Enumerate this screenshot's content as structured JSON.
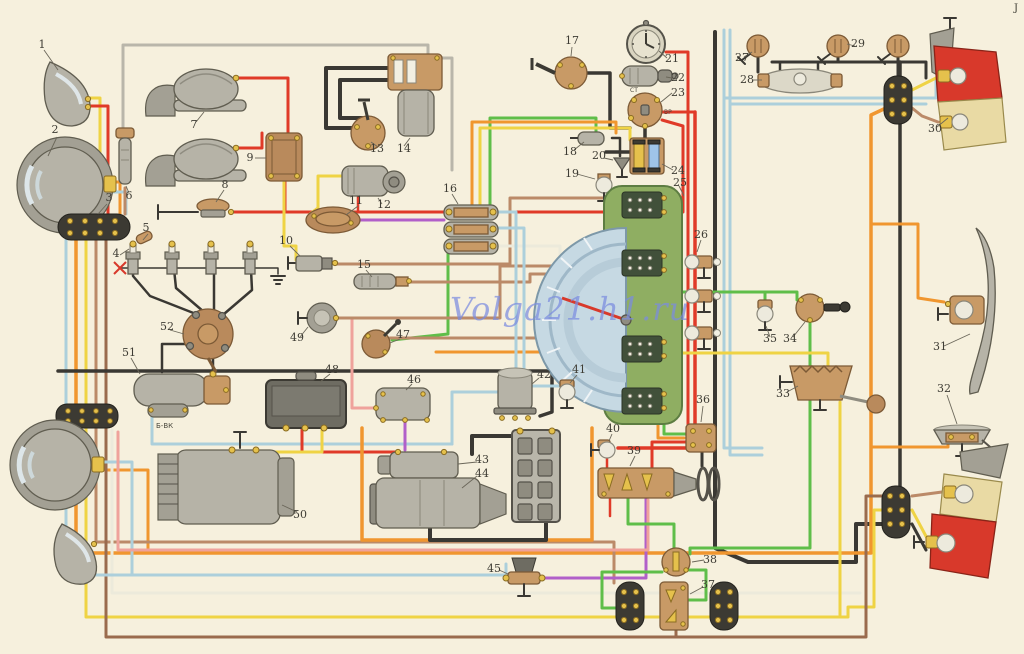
{
  "meta": {
    "watermark": "Volga21.h1.ru",
    "corner_mark": "J",
    "coil_resistor_label": "Б-ВК",
    "ignition_terminal_st": "СТ",
    "ignition_terminal_vr": "ВР"
  },
  "palette": {
    "background": "#f6f0dd",
    "wire_black": "#3a3833",
    "wire_red": "#e03a28",
    "wire_orange": "#f0962f",
    "wire_yellow": "#efd344",
    "wire_lightblue": "#accfdb",
    "wire_green": "#5fbe49",
    "wire_violet": "#b15fc9",
    "wire_pink": "#efa29b",
    "wire_brown": "#bb8a68",
    "wire_darkbrown": "#9a6b4d",
    "wire_white": "#eceadb",
    "wire_gray": "#b9b6aa",
    "panel_green": "#8fae62",
    "lamp_red": "#d8392b",
    "lamp_cream": "#e9daa4"
  },
  "callouts": {
    "c1": "1",
    "c2": "2",
    "c3": "3",
    "c4": "4",
    "c5": "5",
    "c6": "6",
    "c7": "7",
    "c8": "8",
    "c9": "9",
    "c10": "10",
    "c11": "11",
    "c12": "12",
    "c13": "13",
    "c14": "14",
    "c15": "15",
    "c16": "16",
    "c17": "17",
    "c18": "18",
    "c19": "19",
    "c20": "20",
    "c21": "21",
    "c22": "22",
    "c23": "23",
    "c24": "24",
    "c25": "25",
    "c26": "26",
    "c27": "27",
    "c28": "28",
    "c29": "29",
    "c30": "30",
    "c31": "31",
    "c32": "32",
    "c33": "33",
    "c34": "34",
    "c35": "35",
    "c36": "36",
    "c37": "37",
    "c38": "38",
    "c39": "39",
    "c40": "40",
    "c41": "41",
    "c42": "42",
    "c43": "43",
    "c44": "44",
    "c45": "45",
    "c46": "46",
    "c47": "47",
    "c48": "48",
    "c49": "49",
    "c50": "50",
    "c51": "51",
    "c52": "52"
  },
  "wires": [
    {
      "name": "wire-gray-fuse6-wiper",
      "c": "#b9b6aa",
      "w": 3,
      "p": "123,130 123,45 428,45 428,58"
    },
    {
      "name": "wire-gray-wiper-branch",
      "c": "#b9b6aa",
      "w": 3,
      "p": "436,58 452,58 452,170"
    },
    {
      "name": "wire-black-wiper-loop-outer",
      "c": "#3a3833",
      "w": 4,
      "p": "352,128 326,128 326,68 392,68"
    },
    {
      "name": "wire-black-wiper-loop-inner",
      "c": "#3a3833",
      "w": 4,
      "p": "362,118 340,118 340,80 392,80"
    },
    {
      "name": "wire-red-horn1",
      "c": "#e03a28",
      "w": 3,
      "p": "236,78 288,78 288,133"
    },
    {
      "name": "wire-red-horn2",
      "c": "#e03a28",
      "w": 3,
      "p": "236,148 262,148 262,133"
    },
    {
      "name": "wire-red-hornrelay-out",
      "c": "#e03a28",
      "w": 3,
      "p": "285,181 285,212"
    },
    {
      "name": "wire-red-hornbutton-ignition",
      "c": "#e03a28",
      "w": 3,
      "p": "234,212 683,212 683,126 662,120"
    },
    {
      "name": "wire-red-clock-feed",
      "c": "#e03a28",
      "w": 3,
      "p": "666,52 688,52 688,442 652,442 652,470"
    },
    {
      "name": "wire-red-ignition-junction",
      "c": "#e03a28",
      "w": 3,
      "p": "662,112 695,112"
    },
    {
      "name": "wire-red-main-trunk",
      "c": "#e03a28",
      "w": 3.5,
      "p": "695,112 695,448 618,448"
    },
    {
      "name": "wire-red-lamp40-drop",
      "c": "#e03a28",
      "w": 2.5,
      "p": "607,458 607,468"
    },
    {
      "name": "wire-red-39-drop",
      "c": "#e03a28",
      "w": 2.5,
      "p": "610,498 610,516"
    },
    {
      "name": "wire-black-17-feed",
      "c": "#3a3833",
      "w": 3.5,
      "p": "587,73 610,73 610,128 630,128"
    },
    {
      "name": "wire-black-23-24",
      "c": "#3a3833",
      "w": 3.5,
      "p": "645,127 645,152 606,152"
    },
    {
      "name": "wire-black-18-20",
      "c": "#3a3833",
      "w": 2.5,
      "p": "612,138 620,138 620,156"
    },
    {
      "name": "wire-black-door27-drop",
      "c": "#3a3833",
      "w": 3,
      "p": "758,57 758,72"
    },
    {
      "name": "wire-black-dome-run",
      "c": "#3a3833",
      "w": 3,
      "p": "772,62 926,62 926,78"
    },
    {
      "name": "wire-black-door29a-drop",
      "c": "#3a3833",
      "w": 3,
      "p": "838,57 838,62"
    },
    {
      "name": "wire-black-door29b-drop",
      "c": "#3a3833",
      "w": 3,
      "p": "898,57 898,78"
    },
    {
      "name": "wire-lblue-top-run1",
      "c": "#accfdb",
      "w": 3,
      "p": "724,98 936,98 936,80"
    },
    {
      "name": "wire-lblue-top-run2",
      "c": "#accfdb",
      "w": 3,
      "p": "730,104 926,104"
    },
    {
      "name": "wire-lblue-trunk1",
      "c": "#accfdb",
      "w": 3,
      "p": "724,30 724,448 762,448"
    },
    {
      "name": "wire-lblue-trunk2",
      "c": "#accfdb",
      "w": 3,
      "p": "730,30 730,455 762,455"
    },
    {
      "name": "wire-black-main-trunk",
      "c": "#3a3833",
      "w": 4,
      "p": "715,32 715,548 748,562 856,562 856,524 882,524"
    },
    {
      "name": "wire-black-right-trunk",
      "c": "#3a3833",
      "w": 3.5,
      "p": "900,62 900,486"
    },
    {
      "name": "wire-yellow-conn-tail30",
      "c": "#efd344",
      "w": 3,
      "p": "912,90 936,78"
    },
    {
      "name": "wire-tan-conn-tail30",
      "c": "#bb8a68",
      "w": 3,
      "p": "912,108 922,116 938,122"
    },
    {
      "name": "wire-orange-main-loop",
      "c": "#f0962f",
      "w": 3.5,
      "p": "76,240 76,553 871,553 871,115 886,108"
    },
    {
      "name": "wire-orange-headlamp-stub",
      "c": "#f0962f",
      "w": 3,
      "p": "100,470 148,470 148,553"
    },
    {
      "name": "wire-orange-trunklamp31",
      "c": "#f0962f",
      "w": 3,
      "p": "871,224 918,224 918,298 944,302"
    },
    {
      "name": "wire-orange-fuelsender32",
      "c": "#f0962f",
      "w": 3,
      "p": "871,447 948,447 948,442"
    },
    {
      "name": "wire-yellow-bus",
      "c": "#efd344",
      "w": 3,
      "p": "86,240 86,617 848,617 848,607 874,607 874,510 882,510"
    },
    {
      "name": "wire-brown-bus",
      "c": "#bb8a68",
      "w": 3,
      "p": "96,240 96,542 614,542 614,583"
    },
    {
      "name": "wire-darkbrown-bus",
      "c": "#9a6b4d",
      "w": 3,
      "p": "106,240 106,637 866,637 866,496 882,496"
    },
    {
      "name": "wire-white-bus",
      "c": "#eceadb",
      "w": 3,
      "p": "112,430 112,593 860,593"
    },
    {
      "name": "wire-lblue-bus",
      "c": "#accfdb",
      "w": 3,
      "p": "66,428 66,575 506,575 506,564"
    },
    {
      "name": "wire-lblue-headlamp-stub",
      "c": "#accfdb",
      "w": 3,
      "p": "100,462 132,462 132,575"
    },
    {
      "name": "wire-lblue-block-upper",
      "c": "#accfdb",
      "w": 3,
      "p": "66,240 66,404"
    },
    {
      "name": "wire-yellow-signal1",
      "c": "#efd344",
      "w": 3,
      "p": "88,98 100,98 100,214"
    },
    {
      "name": "wire-red-signal1",
      "c": "#e03a28",
      "w": 3,
      "p": "88,106 108,106 108,214"
    },
    {
      "name": "wire-orange-headlamp1",
      "c": "#f0962f",
      "w": 3,
      "p": "110,182 120,182 120,214"
    },
    {
      "name": "wire-lblue-headlamp1",
      "c": "#accfdb",
      "w": 3,
      "p": "110,192 126,192 126,214"
    },
    {
      "name": "wire-brown-fuse6",
      "c": "#bb8a68",
      "w": 3,
      "p": "125,188 125,214"
    },
    {
      "name": "wire-black-ground-bus",
      "c": "#3a3833",
      "w": 3.5,
      "p": "58,371 552,371 552,412 540,416"
    },
    {
      "name": "wire-black-plug-ground",
      "c": "#3a3833",
      "w": 1.5,
      "p": "120,268 278,268 278,274"
    },
    {
      "name": "wire-ht-plug1",
      "c": "#3a3833",
      "w": 2.5,
      "p": "196,314 150,296 133,276 133,250"
    },
    {
      "name": "wire-ht-plug2",
      "c": "#3a3833",
      "w": 2.5,
      "p": "204,312 176,288 172,250"
    },
    {
      "name": "wire-ht-plug3",
      "c": "#3a3833",
      "w": 2.5,
      "p": "214,312 214,268 211,250"
    },
    {
      "name": "wire-ht-plug4",
      "c": "#3a3833",
      "w": 2.5,
      "p": "224,314 252,290 250,250"
    },
    {
      "name": "wire-ht-coil-center",
      "c": "#3a3833",
      "w": 2.5,
      "p": "213,372 213,352 209,342"
    },
    {
      "name": "wire-black-coil-distributor",
      "c": "#3a3833",
      "w": 2.5,
      "p": "186,344 162,344 162,372"
    },
    {
      "name": "wire-lblue-coil-run",
      "c": "#accfdb",
      "w": 3,
      "p": "152,416 152,444 452,444"
    },
    {
      "name": "wire-red-regulator-starter",
      "c": "#e03a28",
      "w": 3,
      "p": "302,428 302,452 396,452"
    },
    {
      "name": "wire-yellow-regulator-generator",
      "c": "#efd344",
      "w": 3,
      "p": "322,428 322,452 256,452"
    },
    {
      "name": "wire-pink-relay46-sender49",
      "c": "#efa29b",
      "w": 3,
      "p": "376,408 352,408 352,318 340,318"
    },
    {
      "name": "wire-violet-relay46-starter",
      "c": "#b15fc9",
      "w": 3,
      "p": "405,420 405,450"
    },
    {
      "name": "wire-orange-starter-loop",
      "c": "#f0962f",
      "w": 3.5,
      "p": "362,428 362,540 592,540 592,428"
    },
    {
      "name": "wire-orange-right-branch",
      "c": "#f0962f",
      "w": 3,
      "p": "436,352 658,352 658,438 684,438"
    },
    {
      "name": "wire-violet-45-39",
      "c": "#b15fc9",
      "w": 3,
      "p": "540,578 646,578 646,498"
    },
    {
      "name": "wire-violet-pump-connector",
      "c": "#b15fc9",
      "w": 3,
      "p": "360,220 444,220"
    },
    {
      "name": "wire-green-16-switch47",
      "c": "#5fbe49",
      "w": 3,
      "p": "448,252 448,334 392,340"
    },
    {
      "name": "wire-green-16-up",
      "c": "#5fbe49",
      "w": 3,
      "p": "490,205 490,118 596,118 596,136"
    },
    {
      "name": "wire-yellow-16-up",
      "c": "#efd344",
      "w": 3,
      "p": "480,205 480,128 630,128 630,140"
    },
    {
      "name": "wire-orange-16-up",
      "c": "#f0962f",
      "w": 3,
      "p": "472,205 472,122 616,122 616,133"
    },
    {
      "name": "wire-brown-sender10-cluster",
      "c": "#bb8a68",
      "w": 3,
      "p": "336,264 510,264 510,198 618,198"
    },
    {
      "name": "wire-white-16-cluster",
      "c": "#eceadb",
      "w": 3,
      "p": "497,246 560,246 560,258 618,258"
    },
    {
      "name": "wire-brown-sender49-cluster",
      "c": "#bb8a68",
      "w": 3,
      "p": "336,318 500,318 500,266 618,266"
    },
    {
      "name": "wire-brown-sender15-cluster",
      "c": "#bb8a68",
      "w": 3,
      "p": "410,282 530,282 530,274 618,274"
    },
    {
      "name": "wire-brown-switch47",
      "c": "#bb8a68",
      "w": 3,
      "p": "390,338 540,338 540,310 566,310"
    },
    {
      "name": "wire-lblue-relay42-a",
      "c": "#accfdb",
      "w": 3,
      "p": "500,392 452,392 452,444"
    },
    {
      "name": "wire-lblue-relay42-b",
      "c": "#accfdb",
      "w": 3,
      "p": "532,386 600,386 600,398 618,398"
    },
    {
      "name": "wire-lblue-center1",
      "c": "#accfdb",
      "w": 3,
      "p": "497,212 516,212 516,372"
    },
    {
      "name": "wire-lblue-center2",
      "c": "#accfdb",
      "w": 3,
      "p": "497,228 524,228 524,368"
    },
    {
      "name": "wire-green-cluster-36",
      "c": "#5fbe49",
      "w": 3,
      "p": "664,420 664,434 686,434"
    },
    {
      "name": "wire-green-cluster-34",
      "c": "#5fbe49",
      "w": 3,
      "p": "682,292 797,292 797,300"
    },
    {
      "name": "wire-green-lamp35-stub",
      "c": "#5fbe49",
      "w": 3,
      "p": "765,292 765,300"
    },
    {
      "name": "wire-green-34-flasher",
      "c": "#5fbe49",
      "w": 3,
      "p": "810,322 810,548 690,548 690,554"
    },
    {
      "name": "wire-yellow-cluster-33",
      "c": "#efd344",
      "w": 3,
      "p": "682,353 828,353 828,366"
    },
    {
      "name": "wire-yellow-33-tail",
      "c": "#efd344",
      "w": 3,
      "p": "840,402 840,615"
    },
    {
      "name": "wire-pink-long",
      "c": "#efa29b",
      "w": 3,
      "p": "118,432 118,550 648,550 648,500"
    },
    {
      "name": "wire-green-39-flasher38",
      "c": "#5fbe49",
      "w": 3,
      "p": "628,498 628,524 674,524 674,549"
    },
    {
      "name": "wire-green-loop-left",
      "c": "#5fbe49",
      "w": 3,
      "p": "662,572 602,572 602,608 618,608"
    },
    {
      "name": "wire-green-loop-right",
      "c": "#5fbe49",
      "w": 3,
      "p": "688,570 706,570 706,600 688,600"
    },
    {
      "name": "wire-black-battery-starter",
      "c": "#3a3833",
      "w": 4,
      "p": "520,436 472,436 472,454"
    },
    {
      "name": "wire-black-battery-ground",
      "c": "#3a3833",
      "w": 4,
      "p": "546,522 546,540 430,540 430,528"
    },
    {
      "name": "wire-black-36-39",
      "c": "#3a3833",
      "w": 3,
      "p": "702,452 702,466"
    },
    {
      "name": "wire-yellow-relay9-sender10",
      "c": "#efd344",
      "w": 3,
      "p": "284,182 284,246 296,246 296,260"
    },
    {
      "name": "wire-yellow-washer-loop",
      "c": "#efd344",
      "w": 3,
      "p": "342,176 318,176 318,208 310,214"
    },
    {
      "name": "wire-red-motor12",
      "c": "#e03a28",
      "w": 2.5,
      "p": "358,196 358,212"
    },
    {
      "name": "wire-brown-37-bus",
      "c": "#9a6b4d",
      "w": 3,
      "p": "676,630 676,637"
    },
    {
      "name": "wire-tan-conn-sock1",
      "c": "#bb8a68",
      "w": 3,
      "p": "912,496 942,492"
    },
    {
      "name": "wire-yellow-conn-sock2",
      "c": "#efd344",
      "w": 3,
      "p": "912,510 928,540"
    },
    {
      "name": "wire-black-conn-sock3",
      "c": "#3a3833",
      "w": 3,
      "p": "912,524 926,550"
    }
  ]
}
